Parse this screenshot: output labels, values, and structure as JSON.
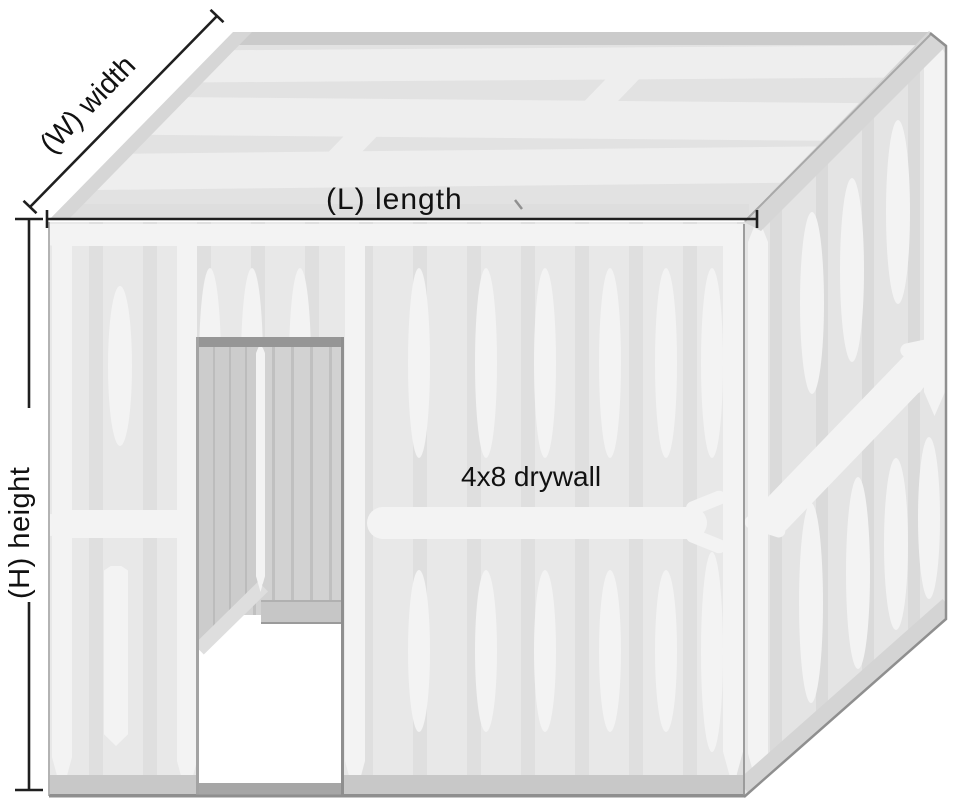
{
  "diagram": {
    "labels": {
      "width": "(W) width",
      "length": "(L) length",
      "height": "(H) height",
      "drywall": "4x8 drywall"
    },
    "colors": {
      "background": "#ffffff",
      "wall": "#e8e8e8",
      "wall_stripe": "#dfdfdf",
      "joint_tape": "#f3f3f3",
      "roof": "#e2e2e2",
      "roof_band": "#eeeeee",
      "roof_back_edge": "#cbcbcb",
      "fascia": "#d6d6d6",
      "side_wall": "#e4e4e4",
      "interior_wall": "#d2d2d2",
      "door_frame": "#969696",
      "baseboard": "#c8c8c8",
      "outline": "#8f8f8f",
      "dimension_line": "#1f1f1f"
    }
  }
}
